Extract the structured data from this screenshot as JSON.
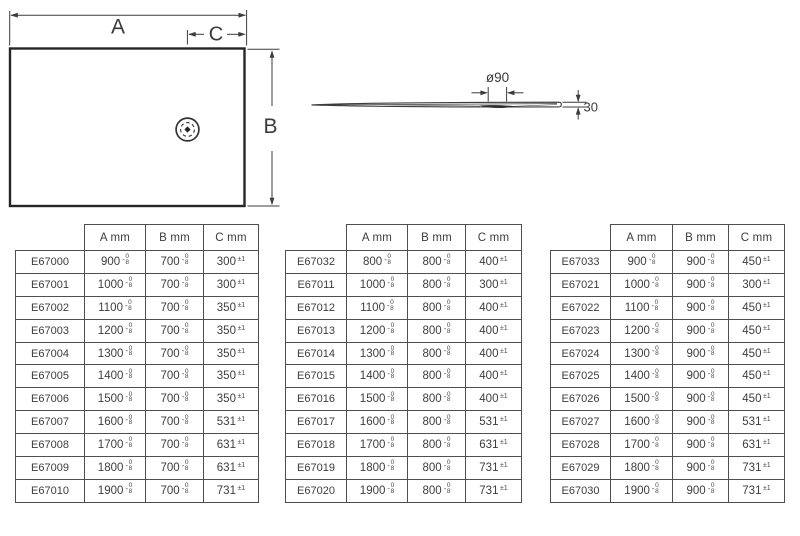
{
  "plan_view": {
    "width_label": "A",
    "depth_label": "B",
    "drain_offset_label": "C"
  },
  "profile_view": {
    "drain_diameter_label": "ø90",
    "thickness_label": "30"
  },
  "tolerance": {
    "ab_sign": "-",
    "ab_upper": "0",
    "ab_lower": "8",
    "c": "±1"
  },
  "tables": [
    {
      "headers": [
        "A mm",
        "B mm",
        "C mm"
      ],
      "rows": [
        {
          "code": "E67000",
          "a": "900",
          "b": "700",
          "c": "300"
        },
        {
          "code": "E67001",
          "a": "1000",
          "b": "700",
          "c": "300"
        },
        {
          "code": "E67002",
          "a": "1100",
          "b": "700",
          "c": "350"
        },
        {
          "code": "E67003",
          "a": "1200",
          "b": "700",
          "c": "350"
        },
        {
          "code": "E67004",
          "a": "1300",
          "b": "700",
          "c": "350"
        },
        {
          "code": "E67005",
          "a": "1400",
          "b": "700",
          "c": "350"
        },
        {
          "code": "E67006",
          "a": "1500",
          "b": "700",
          "c": "350"
        },
        {
          "code": "E67007",
          "a": "1600",
          "b": "700",
          "c": "531"
        },
        {
          "code": "E67008",
          "a": "1700",
          "b": "700",
          "c": "631"
        },
        {
          "code": "E67009",
          "a": "1800",
          "b": "700",
          "c": "631"
        },
        {
          "code": "E67010",
          "a": "1900",
          "b": "700",
          "c": "731"
        }
      ]
    },
    {
      "headers": [
        "A mm",
        "B mm",
        "C mm"
      ],
      "rows": [
        {
          "code": "E67032",
          "a": "800",
          "b": "800",
          "c": "400"
        },
        {
          "code": "E67011",
          "a": "1000",
          "b": "800",
          "c": "300"
        },
        {
          "code": "E67012",
          "a": "1100",
          "b": "800",
          "c": "400"
        },
        {
          "code": "E67013",
          "a": "1200",
          "b": "800",
          "c": "400"
        },
        {
          "code": "E67014",
          "a": "1300",
          "b": "800",
          "c": "400"
        },
        {
          "code": "E67015",
          "a": "1400",
          "b": "800",
          "c": "400"
        },
        {
          "code": "E67016",
          "a": "1500",
          "b": "800",
          "c": "400"
        },
        {
          "code": "E67017",
          "a": "1600",
          "b": "800",
          "c": "531"
        },
        {
          "code": "E67018",
          "a": "1700",
          "b": "800",
          "c": "631"
        },
        {
          "code": "E67019",
          "a": "1800",
          "b": "800",
          "c": "731"
        },
        {
          "code": "E67020",
          "a": "1900",
          "b": "800",
          "c": "731"
        }
      ]
    },
    {
      "headers": [
        "A mm",
        "B mm",
        "C mm"
      ],
      "rows": [
        {
          "code": "E67033",
          "a": "900",
          "b": "900",
          "c": "450"
        },
        {
          "code": "E67021",
          "a": "1000",
          "b": "900",
          "c": "300"
        },
        {
          "code": "E67022",
          "a": "1100",
          "b": "900",
          "c": "450"
        },
        {
          "code": "E67023",
          "a": "1200",
          "b": "900",
          "c": "450"
        },
        {
          "code": "E67024",
          "a": "1300",
          "b": "900",
          "c": "450"
        },
        {
          "code": "E67025",
          "a": "1400",
          "b": "900",
          "c": "450"
        },
        {
          "code": "E67026",
          "a": "1500",
          "b": "900",
          "c": "450"
        },
        {
          "code": "E67027",
          "a": "1600",
          "b": "900",
          "c": "531"
        },
        {
          "code": "E67028",
          "a": "1700",
          "b": "900",
          "c": "631"
        },
        {
          "code": "E67029",
          "a": "1800",
          "b": "900",
          "c": "731"
        },
        {
          "code": "E67030",
          "a": "1900",
          "b": "900",
          "c": "731"
        }
      ]
    }
  ]
}
